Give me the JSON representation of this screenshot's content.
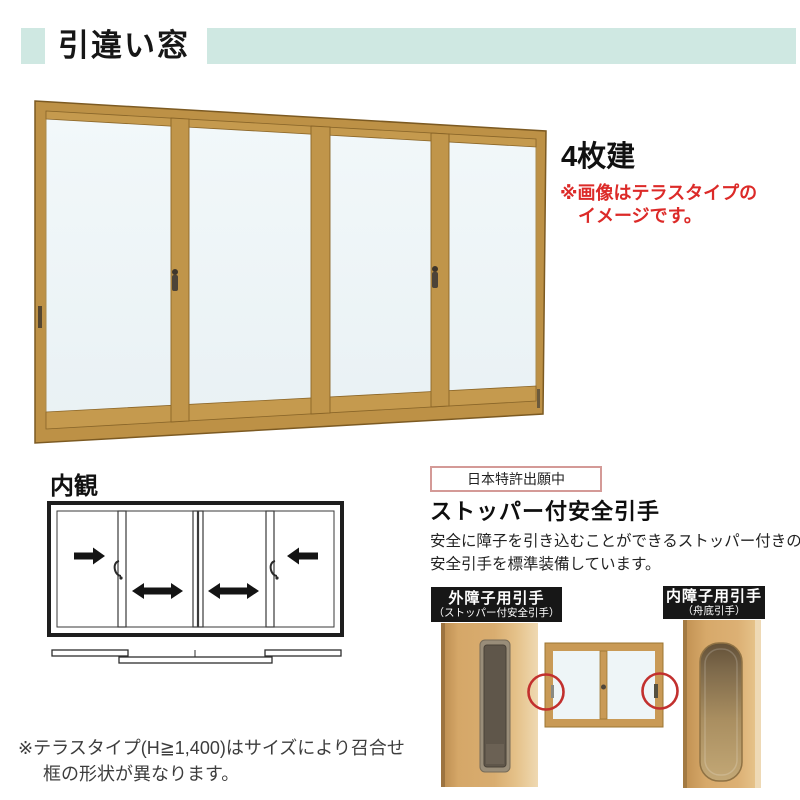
{
  "colors": {
    "band_teal": "#cfe8e2",
    "accent_red": "#dc2a28",
    "frame_gold": "#bd9146",
    "glass": "#eef5f7",
    "patent_border_pink": "#d49a97",
    "label_black": "#171717",
    "highlight_circle_red": "#c2302e"
  },
  "header": {
    "title": "引違い窓"
  },
  "main_view": {
    "panel_count_label": "4枚建",
    "note": {
      "line1": "※画像はテラスタイプの",
      "line2": "イメージです。"
    }
  },
  "interior_view": {
    "title": "内観",
    "arrow_icons": [
      "right-arrow",
      "double-arrow",
      "double-arrow",
      "left-arrow"
    ]
  },
  "safety_pull_feature": {
    "patent_badge": "日本特許出願中",
    "heading": "ストッパー付安全引手",
    "description": {
      "line1": "安全に障子を引き込むことができるストッパー付きの",
      "line2": "安全引手を標準装備しています。"
    },
    "outer_handle_label": {
      "line1": "外障子用引手",
      "line2": "（ストッパー付安全引手）"
    },
    "inner_handle_label": {
      "line1": "内障子用引手",
      "line2": "（舟底引手）"
    }
  },
  "footnote": {
    "line1": "※テラスタイプ(H≧1,400)はサイズにより召合せ",
    "line2": "框の形状が異なります。"
  }
}
